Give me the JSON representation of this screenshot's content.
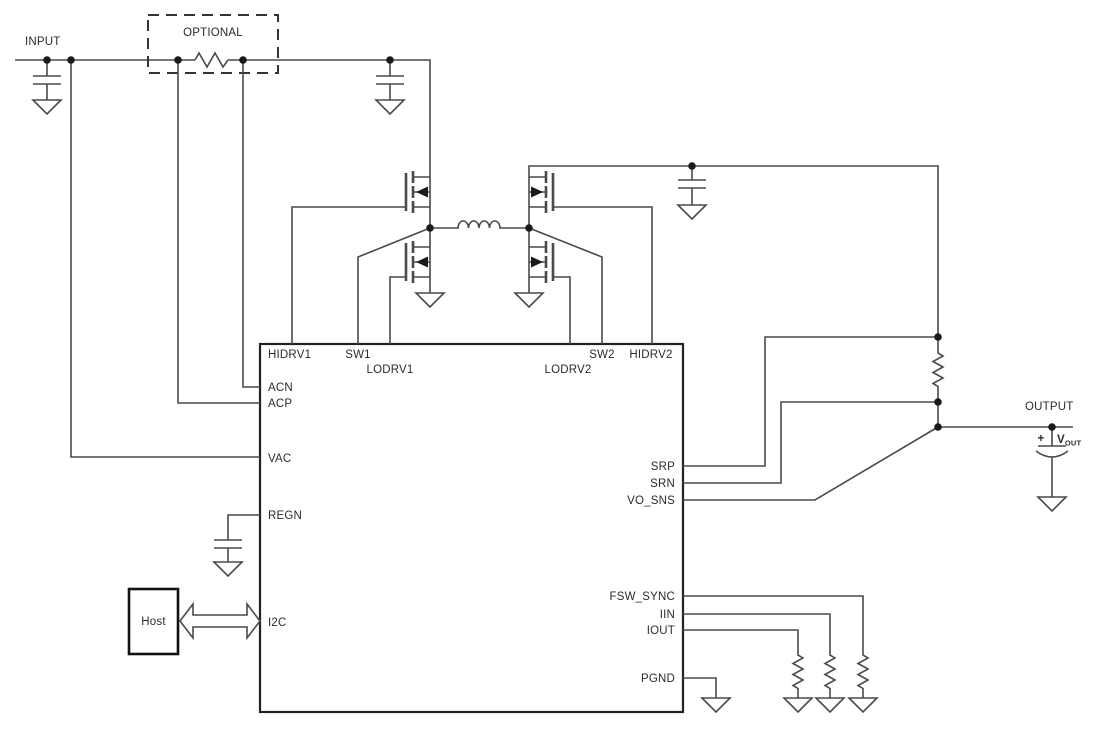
{
  "schematic": {
    "labels": {
      "input": "INPUT",
      "optional": "OPTIONAL",
      "output": "OUTPUT",
      "host": "Host"
    },
    "vout": {
      "plus": "+",
      "symbol": "V",
      "subscript": "OUT"
    },
    "ic_pins": {
      "hidrv1": "HIDRV1",
      "sw1": "SW1",
      "lodrv1": "LODRV1",
      "lodrv2": "LODRV2",
      "sw2": "SW2",
      "hidrv2": "HIDRV2",
      "acn": "ACN",
      "acp": "ACP",
      "vac": "VAC",
      "regn": "REGN",
      "i2c": "I2C",
      "srp": "SRP",
      "srn": "SRN",
      "vo_sns": "VO_SNS",
      "fsw_sync": "FSW_SYNC",
      "iin": "IIN",
      "iout": "IOUT",
      "pgnd": "PGND"
    },
    "colors": {
      "wire": "#4a4a4a",
      "outline": "#222222",
      "text": "#2b2b2b",
      "bg": "#ffffff"
    }
  }
}
